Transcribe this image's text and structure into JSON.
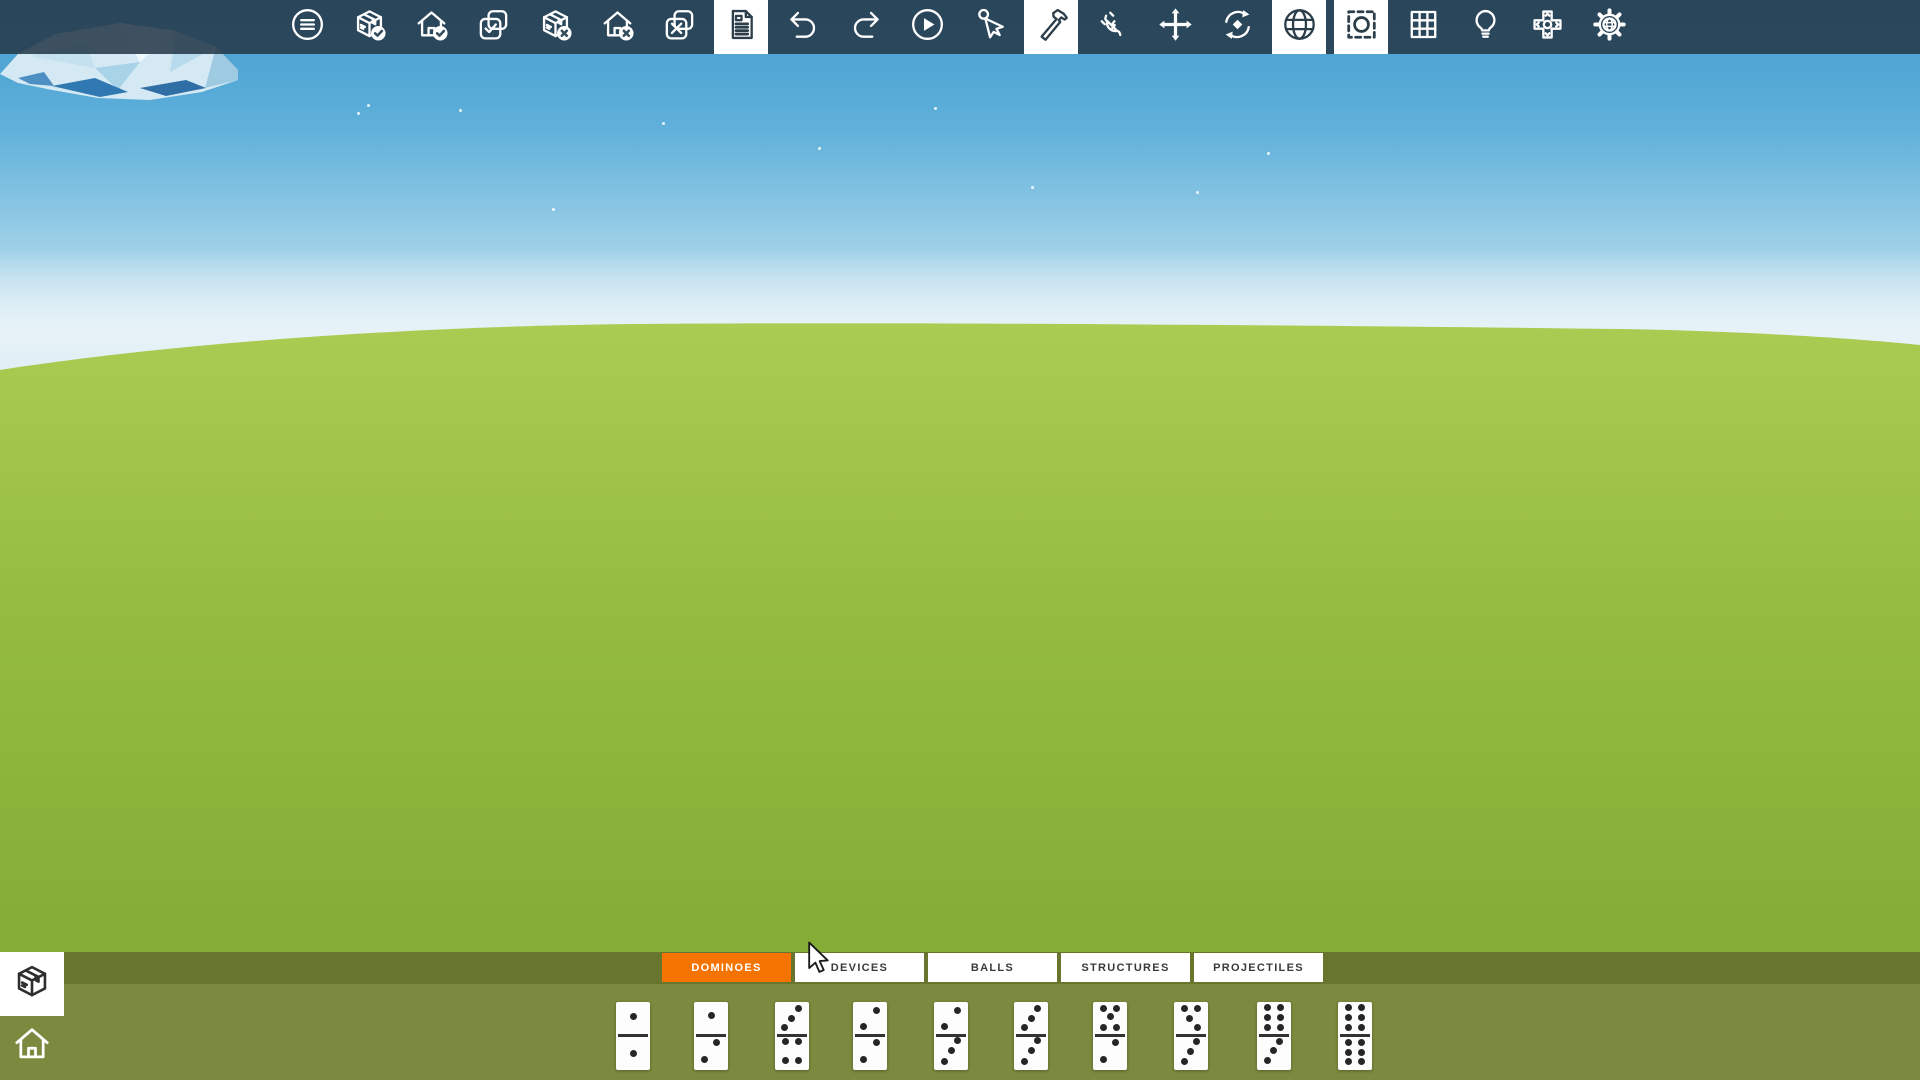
{
  "toolbar": {
    "background": "rgba(39,58,74,0.88)",
    "icon_color": "#ffffff",
    "selected_bg": "#ffffff",
    "selected_icon_color": "#2c3e4a",
    "buttons": [
      {
        "name": "menu",
        "selected": false
      },
      {
        "name": "save-box",
        "selected": false
      },
      {
        "name": "save-home",
        "selected": false
      },
      {
        "name": "confirm-selection",
        "selected": false
      },
      {
        "name": "delete-box",
        "selected": false
      },
      {
        "name": "delete-home",
        "selected": false
      },
      {
        "name": "cancel-selection",
        "selected": false
      },
      {
        "name": "document",
        "selected": true
      },
      {
        "name": "undo",
        "selected": false
      },
      {
        "name": "redo",
        "selected": false
      },
      {
        "name": "play",
        "selected": false
      },
      {
        "name": "pointer",
        "selected": false
      },
      {
        "name": "hammer",
        "selected": true
      },
      {
        "name": "plug",
        "selected": false
      },
      {
        "name": "move",
        "selected": false
      },
      {
        "name": "rotate",
        "selected": false
      },
      {
        "name": "globe",
        "selected": true
      },
      {
        "name": "focus",
        "selected": true
      },
      {
        "name": "grid",
        "selected": false
      },
      {
        "name": "bulb",
        "selected": false
      },
      {
        "name": "dpad",
        "selected": false
      },
      {
        "name": "world-settings",
        "selected": false
      }
    ]
  },
  "scene": {
    "sky_top": "#439ccf",
    "sky_upper": "#5fb0da",
    "sky_lower": "#9ed0e7",
    "sky_horizon": "#d9edf5",
    "grass_top": "#abcc53",
    "grass_mid": "#96bd41",
    "grass_bottom": "#7da632",
    "cloud_light": "#d4e9f3",
    "cloud_shadow": "#2f78b2",
    "particles": [
      [
        357,
        112
      ],
      [
        367,
        104
      ],
      [
        459,
        109
      ],
      [
        552,
        208
      ],
      [
        662,
        122
      ],
      [
        818,
        147
      ],
      [
        934,
        107
      ],
      [
        1031,
        186
      ],
      [
        1196,
        191
      ],
      [
        1267,
        152
      ]
    ]
  },
  "bottom_panel": {
    "tab_row_bg": "#67752f",
    "panel_bg": "#7b8a3e",
    "accent": "#f47301",
    "tabs": [
      {
        "label": "DOMINOES",
        "selected": true
      },
      {
        "label": "DEVICES",
        "selected": false
      },
      {
        "label": "BALLS",
        "selected": false
      },
      {
        "label": "STRUCTURES",
        "selected": false
      },
      {
        "label": "PROJECTILES",
        "selected": false
      }
    ],
    "domino_centers": [
      633,
      711,
      792,
      870,
      951,
      1031,
      1110,
      1191,
      1274,
      1355
    ],
    "dominoes": [
      {
        "label": "1|1",
        "top": [
          [
            0.5,
            0.22
          ]
        ],
        "bottom": [
          [
            0.5,
            0.76
          ]
        ]
      },
      {
        "label": "1|2",
        "top": [
          [
            0.5,
            0.2
          ]
        ],
        "bottom": [
          [
            0.66,
            0.6
          ],
          [
            0.3,
            0.85
          ]
        ]
      },
      {
        "label": "3|4",
        "top": [
          [
            0.68,
            0.1
          ],
          [
            0.48,
            0.24
          ],
          [
            0.28,
            0.38
          ]
        ],
        "bottom": [
          [
            0.32,
            0.58
          ],
          [
            0.68,
            0.58
          ],
          [
            0.32,
            0.86
          ],
          [
            0.68,
            0.86
          ]
        ]
      },
      {
        "label": "2|2",
        "top": [
          [
            0.68,
            0.13
          ],
          [
            0.3,
            0.36
          ]
        ],
        "bottom": [
          [
            0.68,
            0.6
          ],
          [
            0.32,
            0.84
          ]
        ]
      },
      {
        "label": "2|3",
        "top": [
          [
            0.68,
            0.13
          ],
          [
            0.3,
            0.36
          ]
        ],
        "bottom": [
          [
            0.68,
            0.57
          ],
          [
            0.5,
            0.72
          ],
          [
            0.3,
            0.87
          ]
        ]
      },
      {
        "label": "3|3",
        "top": [
          [
            0.68,
            0.1
          ],
          [
            0.5,
            0.24
          ],
          [
            0.3,
            0.38
          ]
        ],
        "bottom": [
          [
            0.68,
            0.57
          ],
          [
            0.5,
            0.72
          ],
          [
            0.3,
            0.87
          ]
        ]
      },
      {
        "label": "5|2",
        "top": [
          [
            0.3,
            0.09
          ],
          [
            0.7,
            0.09
          ],
          [
            0.5,
            0.22
          ],
          [
            0.3,
            0.37
          ],
          [
            0.7,
            0.37
          ]
        ],
        "bottom": [
          [
            0.66,
            0.6
          ],
          [
            0.32,
            0.84
          ]
        ]
      },
      {
        "label": "4|3",
        "top": [
          [
            0.3,
            0.09
          ],
          [
            0.7,
            0.09
          ],
          [
            0.46,
            0.24
          ],
          [
            0.7,
            0.38
          ]
        ],
        "bottom": [
          [
            0.66,
            0.58
          ],
          [
            0.48,
            0.73
          ],
          [
            0.3,
            0.87
          ]
        ]
      },
      {
        "label": "6|3",
        "top": [
          [
            0.32,
            0.08
          ],
          [
            0.68,
            0.08
          ],
          [
            0.32,
            0.23
          ],
          [
            0.68,
            0.23
          ],
          [
            0.32,
            0.38
          ],
          [
            0.68,
            0.38
          ]
        ],
        "bottom": [
          [
            0.66,
            0.58
          ],
          [
            0.48,
            0.72
          ],
          [
            0.3,
            0.86
          ]
        ]
      },
      {
        "label": "6|6",
        "top": [
          [
            0.32,
            0.08
          ],
          [
            0.68,
            0.08
          ],
          [
            0.32,
            0.23
          ],
          [
            0.68,
            0.23
          ],
          [
            0.32,
            0.38
          ],
          [
            0.68,
            0.38
          ]
        ],
        "bottom": [
          [
            0.32,
            0.6
          ],
          [
            0.68,
            0.6
          ],
          [
            0.32,
            0.74
          ],
          [
            0.68,
            0.74
          ],
          [
            0.32,
            0.88
          ],
          [
            0.68,
            0.88
          ]
        ]
      }
    ]
  }
}
